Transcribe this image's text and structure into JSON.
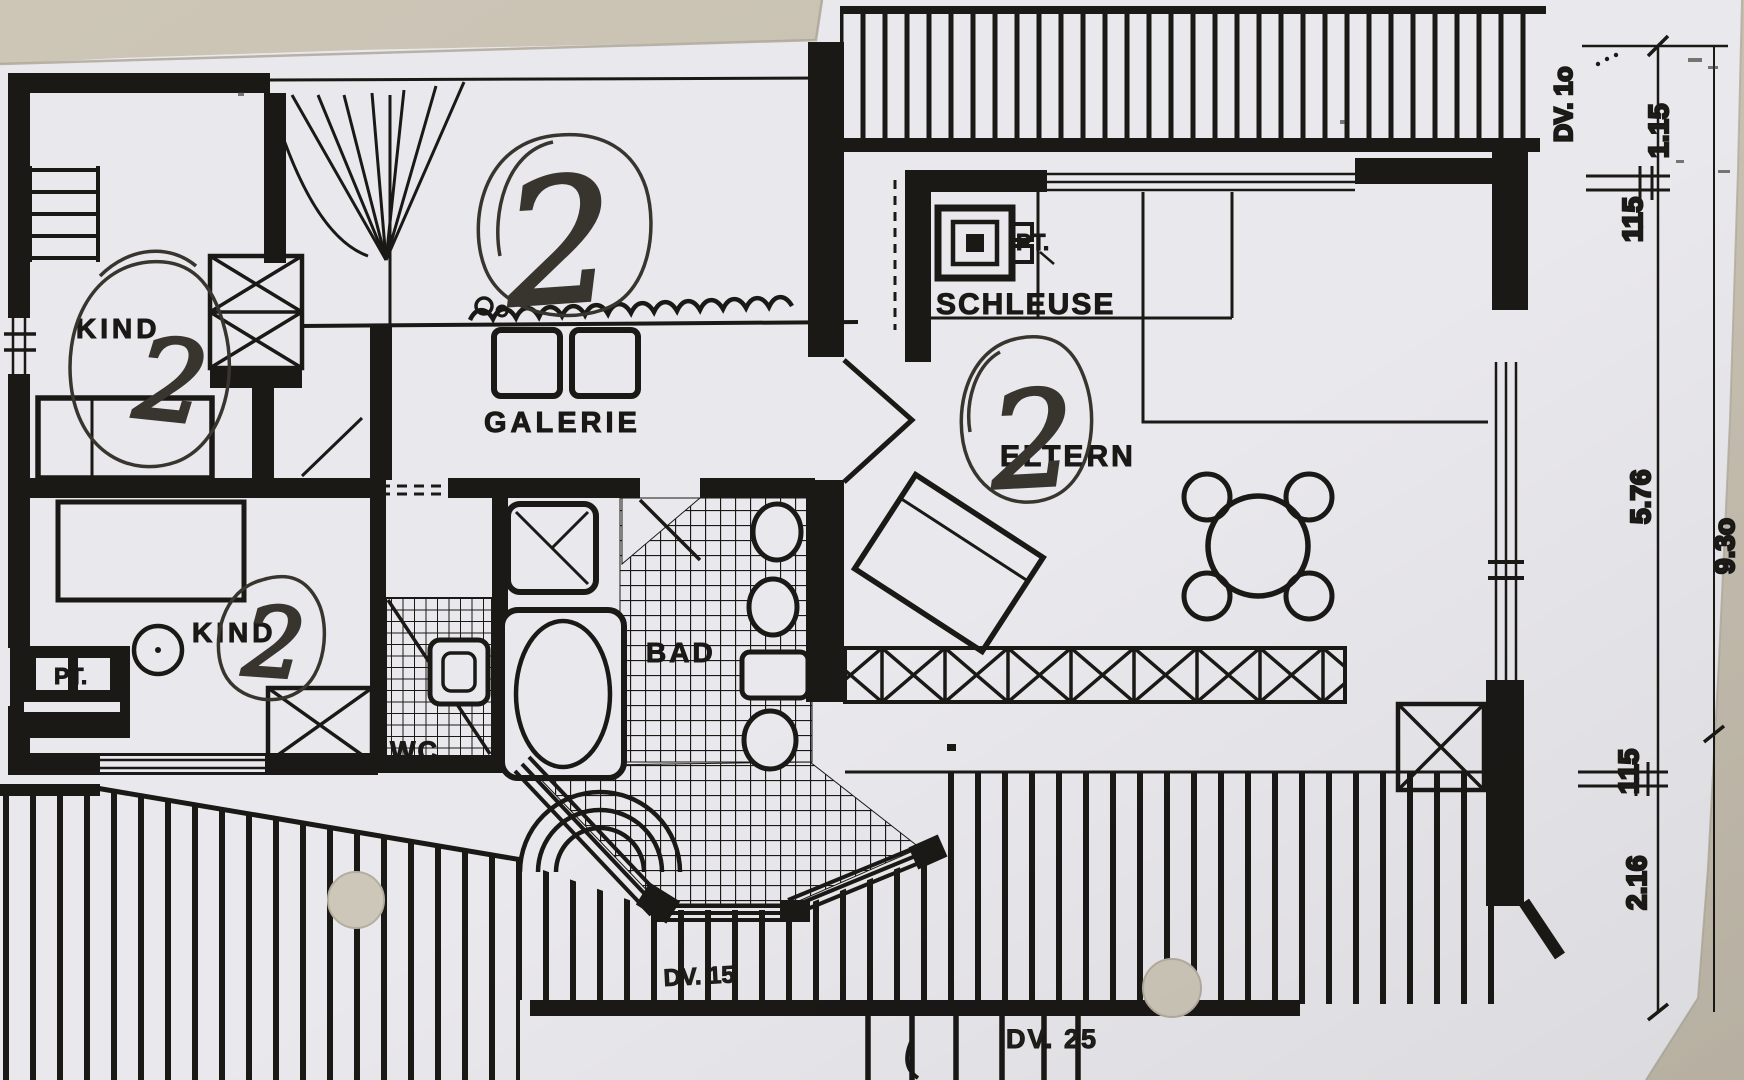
{
  "document": {
    "kind": "photographed floor plan photocopy",
    "colors": {
      "background_wall": "#c9c2b3",
      "paper": "#e9e8ec",
      "ink": "#1a1916",
      "pen_annotation": "#38342e",
      "punch_hole": "#cdc7b9"
    }
  },
  "rooms": {
    "kind_upper": {
      "label": "KIND"
    },
    "kind_lower": {
      "label": "KIND"
    },
    "galerie": {
      "label": "GALERIE"
    },
    "schleuse": {
      "label": "SCHLEUSE"
    },
    "eltern": {
      "label": "ELTERN"
    },
    "bad": {
      "label": "BAD"
    },
    "wc": {
      "label": "WC."
    },
    "pt_schleuse": {
      "label": "PT."
    },
    "pt_kind": {
      "label": "PT."
    }
  },
  "handwritten_marks": {
    "galerie": "2",
    "kind_upper": "2",
    "kind_lower": "2",
    "eltern": "2"
  },
  "dimension_labels": {
    "door_top": "DV. 1o",
    "width_top": "1.15",
    "wall_top": "115",
    "room_height": "5.76",
    "wall_bottom": "115",
    "balcony_depth": "2.16",
    "total_height": "9.3o",
    "door_bay": "DV. 15",
    "door_balcony": "DV. 25"
  }
}
